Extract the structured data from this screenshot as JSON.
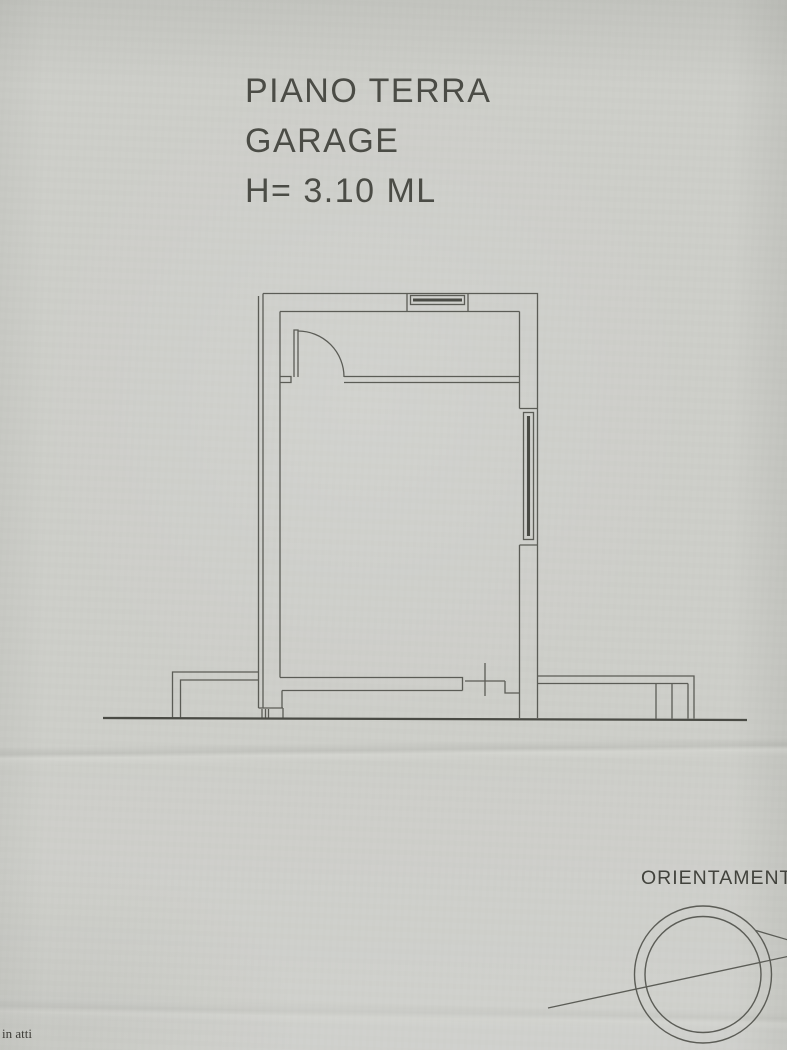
{
  "document": {
    "title_block": {
      "line1": "PIANO TERRA",
      "line2": "GARAGE",
      "line3": "H= 3.10 ML"
    },
    "compass_label": "ORIENTAMENTO",
    "margin_note": "in atti"
  },
  "colors": {
    "paper": "#cdcec9",
    "ink": "#5b5c56",
    "ink_heavy": "#4a4b45",
    "title_text": "#4b4c46",
    "label_text": "#42433d",
    "note_text": "#3d3c37"
  }
}
